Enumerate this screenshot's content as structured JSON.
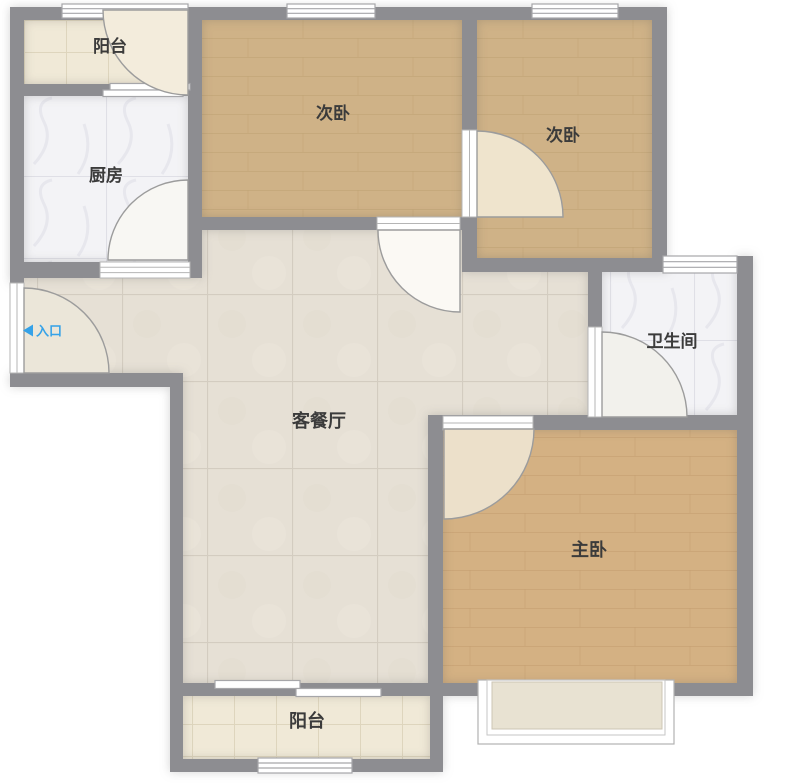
{
  "floorplan": {
    "type": "apartment-floor-plan",
    "entrance": {
      "label": "入口",
      "direction": "left"
    },
    "rooms": [
      {
        "id": "balcony-top",
        "label": "阳台",
        "floor": "cream-tile"
      },
      {
        "id": "kitchen",
        "label": "厨房",
        "floor": "white-marble-tile"
      },
      {
        "id": "bedroom-secondary-1",
        "label": "次卧",
        "floor": "wood"
      },
      {
        "id": "bedroom-secondary-2",
        "label": "次卧",
        "floor": "wood"
      },
      {
        "id": "bathroom",
        "label": "卫生间",
        "floor": "white-marble-tile"
      },
      {
        "id": "living-dining",
        "label": "客餐厅",
        "floor": "beige-tile"
      },
      {
        "id": "bedroom-master",
        "label": "主卧",
        "floor": "wood"
      },
      {
        "id": "balcony-bottom",
        "label": "阳台",
        "floor": "cream-tile"
      }
    ],
    "colors": {
      "wall": "#8d8d91",
      "wood_floor": "#cfb287",
      "wood_floor_master": "#d4b183",
      "living_tile": "#e6e0d5",
      "white_tile": "#f3f3f6",
      "cream_tile": "#f0e9d7",
      "door_leaf": "#efe5d0",
      "entry_text": "#35a2e8",
      "label_text": "#3b3b3b",
      "window_fill": "#ffffff"
    }
  }
}
